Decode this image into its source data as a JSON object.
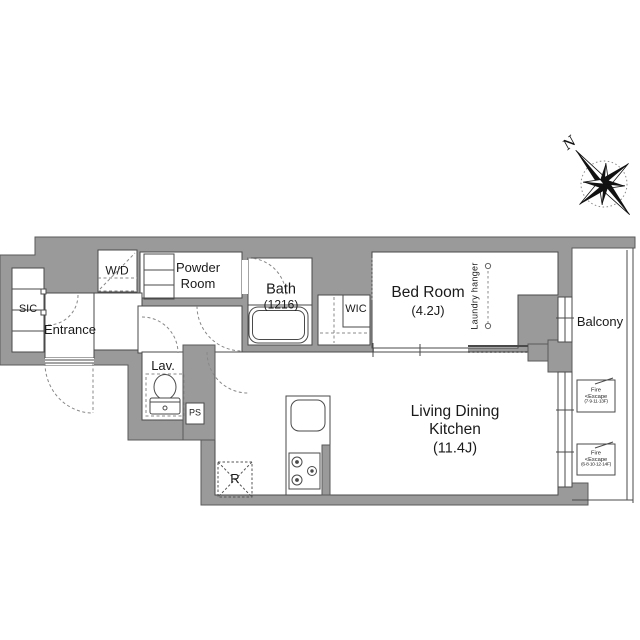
{
  "title": "Apartment floor plan",
  "colors": {
    "wall": "#9a9a9a",
    "line": "#4a4a4a",
    "dash": "#888888",
    "background": "#ffffff",
    "text": "#1a1a1a"
  },
  "rooms": {
    "sic": {
      "label": "SIC"
    },
    "entrance": {
      "label": "Entrance"
    },
    "wd": {
      "label": "W/D"
    },
    "powder": {
      "line1": "Powder",
      "line2": "Room"
    },
    "bath": {
      "label": "Bath",
      "size": "(1216)"
    },
    "wic": {
      "label": "WIC"
    },
    "bedroom": {
      "label": "Bed Room",
      "size": "(4.2J)"
    },
    "laundry_hanger": {
      "label": "Laundry hanger"
    },
    "lav": {
      "label": "Lav."
    },
    "ps": {
      "label": "PS"
    },
    "ldk": {
      "line1": "Living Dining",
      "line2": "Kitchen",
      "size": "(11.4J)"
    },
    "balcony": {
      "label": "Balcony"
    },
    "fridge": {
      "label": "R"
    }
  },
  "annotations": {
    "fire_escape_1": {
      "line1": "Fire",
      "line2": "<Escape",
      "line3": "(7·9·11·13F)"
    },
    "fire_escape_2": {
      "line1": "Fire",
      "line2": "<Escape",
      "line3": "(6·8·10·12·14F)"
    },
    "compass": {
      "north_label": "N"
    }
  }
}
